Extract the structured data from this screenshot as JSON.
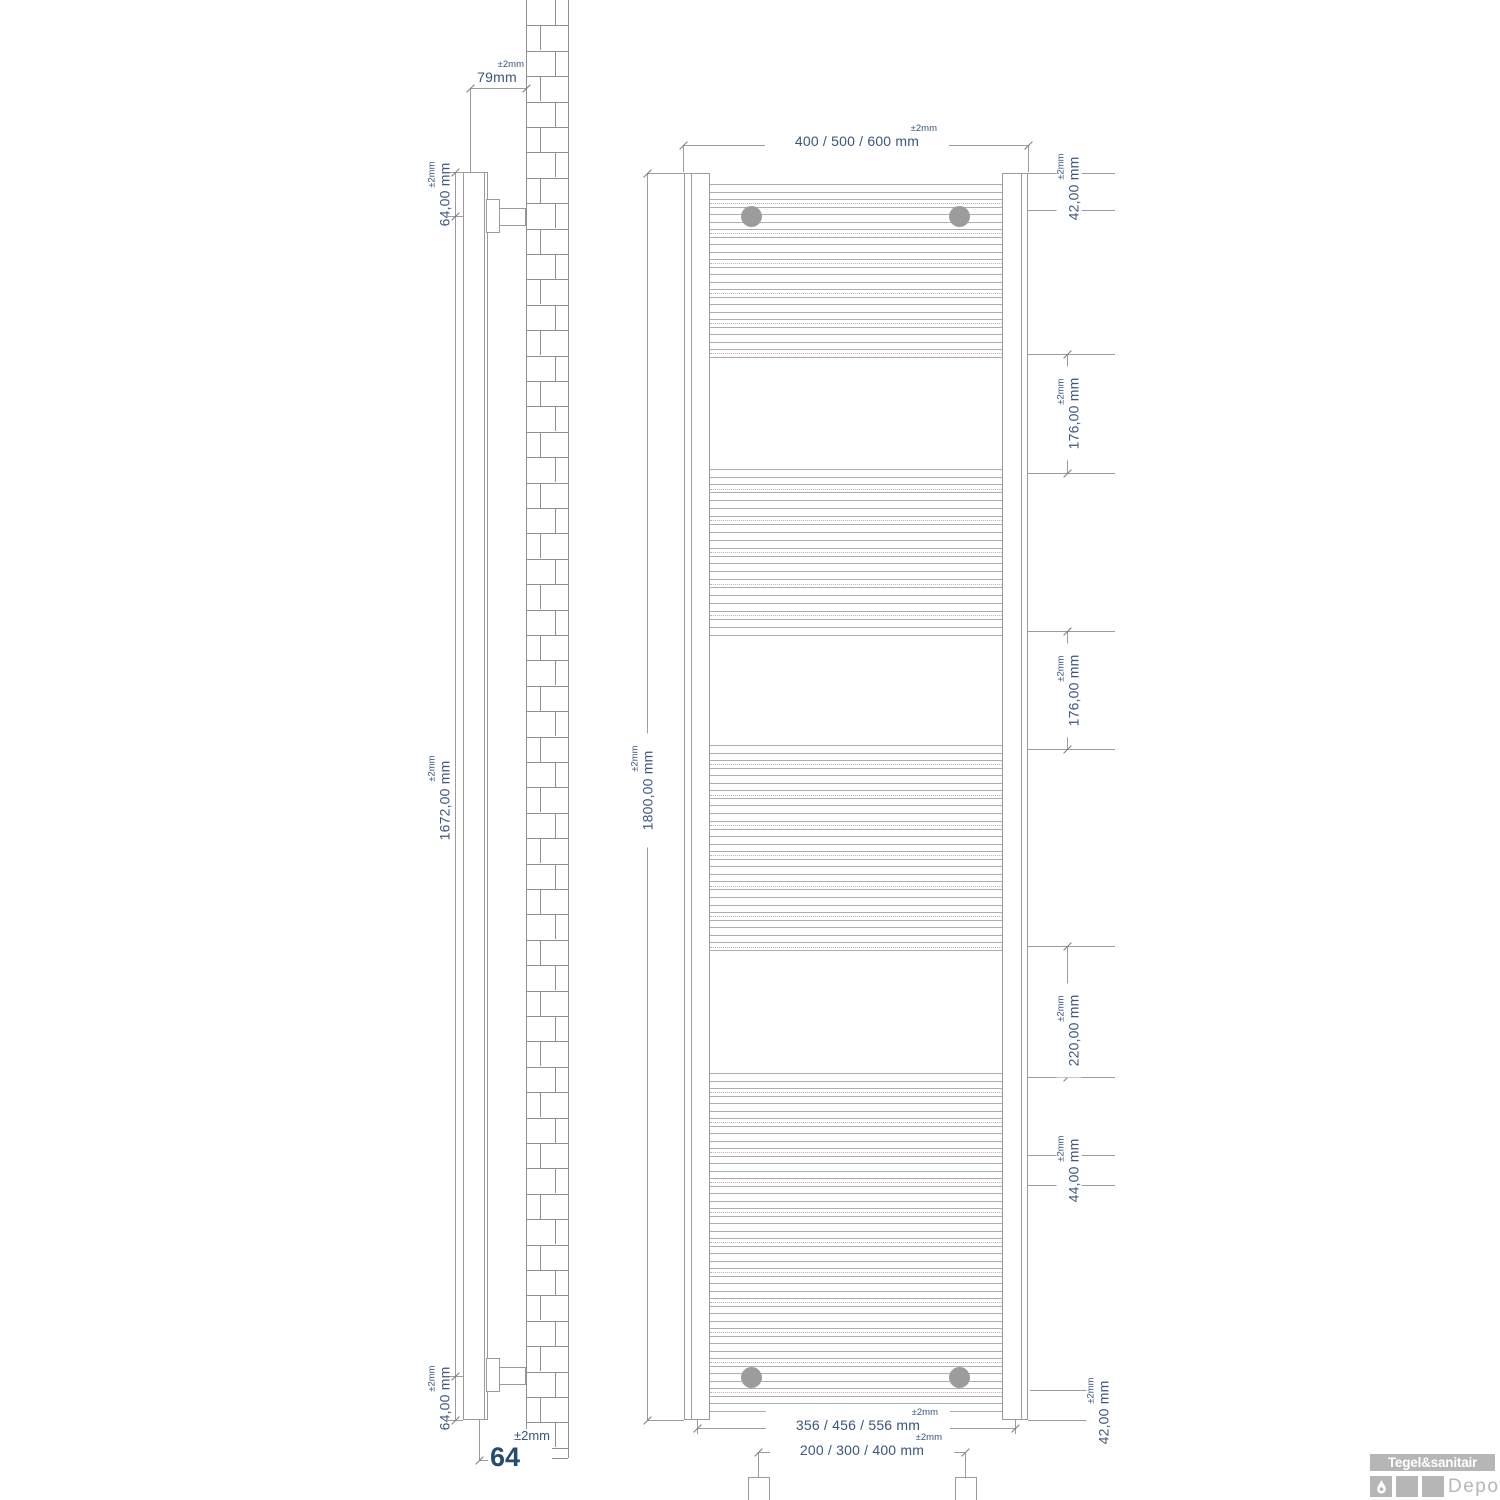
{
  "drawing": {
    "side_view": {
      "dim_depth": {
        "value": "79mm",
        "tol": "±2mm"
      },
      "dim_top_bracket": {
        "value": "64,00 mm",
        "tol": "±2mm"
      },
      "dim_bracket_span": {
        "value": "1672,00 mm",
        "tol": "±2mm"
      },
      "dim_bottom_bracket": {
        "value": "64,00 mm",
        "tol": "±2mm"
      },
      "dim_wall_offset": {
        "value": "64",
        "tol": "±2mm"
      }
    },
    "front_view": {
      "dim_width": {
        "value": "400 / 500 / 600 mm",
        "tol": "±2mm"
      },
      "dim_height": {
        "value": "1800,00 mm",
        "tol": "±2mm"
      },
      "dim_top_gap": {
        "value": "42,00 mm",
        "tol": "±2mm"
      },
      "dim_gap_1": {
        "value": "176,00 mm",
        "tol": "±2mm"
      },
      "dim_gap_2": {
        "value": "176,00 mm",
        "tol": "±2mm"
      },
      "dim_gap_3": {
        "value": "220,00 mm",
        "tol": "±2mm"
      },
      "dim_gap_4": {
        "value": "44,00 mm",
        "tol": "±2mm"
      },
      "dim_bottom_gap": {
        "value": "42,00 mm",
        "tol": "±2mm"
      },
      "dim_inner_width": {
        "value": "356 / 456 / 556 mm",
        "tol": "±2mm"
      },
      "dim_pipe_spacing": {
        "value": "200 / 300 / 400 mm",
        "tol": "±2mm"
      }
    }
  },
  "logo": {
    "brand": "Tegel&sanitair",
    "suffix": "Depot"
  },
  "colors": {
    "dim_text": "#3a567a",
    "line": "#9a9a9a",
    "brick_line": "#8f8f8f",
    "centerline": "#cfa9a9",
    "crosshair": "#c49a9a",
    "mount": "#9c9c9c",
    "logo_gray": "#b6b6b6"
  }
}
